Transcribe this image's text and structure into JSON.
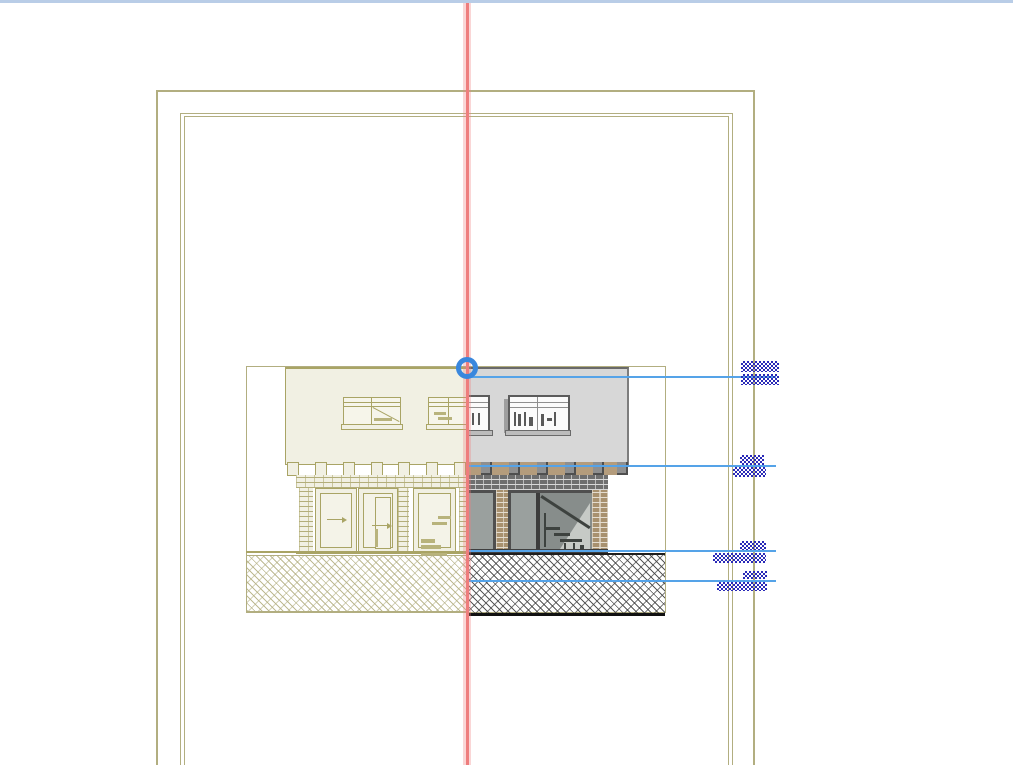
{
  "app": {
    "view": "elevation-drawing",
    "mode": "trace-reference-split-compare"
  },
  "colors": {
    "window_top_strip": "#b9cde7",
    "sheet_border": "#b2ae80",
    "reference_pen": "#a9a465",
    "reference_fill": "#f1f0e3",
    "active_wall_fill": "#d7d7d7",
    "active_line": "#5c5c5c",
    "eave_band": "#b49c7c",
    "glass_fill": "#9aa09e",
    "level_line": "#55a3e8",
    "greeked_text": "#2a2ab8",
    "splitter_line": "#ee7d7d",
    "splitter_handle": "#3a87dd"
  },
  "splitter": {
    "x": 467,
    "handle_cx": 467,
    "handle_cy": 368,
    "aria_label": "Trace reference splitter"
  },
  "level_markers": [
    {
      "name": "level-roof",
      "y": 376,
      "x1": 467,
      "x2": 776,
      "label_top": {
        "x": 741,
        "y": 361,
        "w": 38,
        "h": 11,
        "text": "greeked"
      },
      "label_bottom": {
        "x": 741,
        "y": 374,
        "w": 38,
        "h": 11,
        "text": "greeked"
      }
    },
    {
      "name": "level-eaves",
      "y": 465,
      "x1": 467,
      "x2": 776,
      "label_top": {
        "x": 740,
        "y": 455,
        "w": 24,
        "h": 10,
        "text": "greeked"
      },
      "label_bottom": {
        "x": 733,
        "y": 467,
        "w": 33,
        "h": 10,
        "text": "greeked"
      }
    },
    {
      "name": "level-ground-floor",
      "y": 550,
      "x1": 467,
      "x2": 776,
      "label_top": {
        "x": 740,
        "y": 541,
        "w": 26,
        "h": 9,
        "text": "greeked"
      },
      "label_bottom": {
        "x": 713,
        "y": 553,
        "w": 53,
        "h": 10,
        "text": "greeked"
      }
    },
    {
      "name": "level-foundation",
      "y": 580,
      "x1": 467,
      "x2": 776,
      "label_top": {
        "x": 743,
        "y": 571,
        "w": 24,
        "h": 8,
        "text": "greeked"
      },
      "label_bottom": {
        "x": 717,
        "y": 582,
        "w": 50,
        "h": 9,
        "text": "greeked"
      }
    }
  ],
  "corbels": {
    "left_xs": [
      287,
      315,
      343,
      371,
      398,
      426,
      454
    ],
    "right_xs": [
      481,
      509,
      537,
      565,
      593,
      617
    ],
    "y": 462
  }
}
